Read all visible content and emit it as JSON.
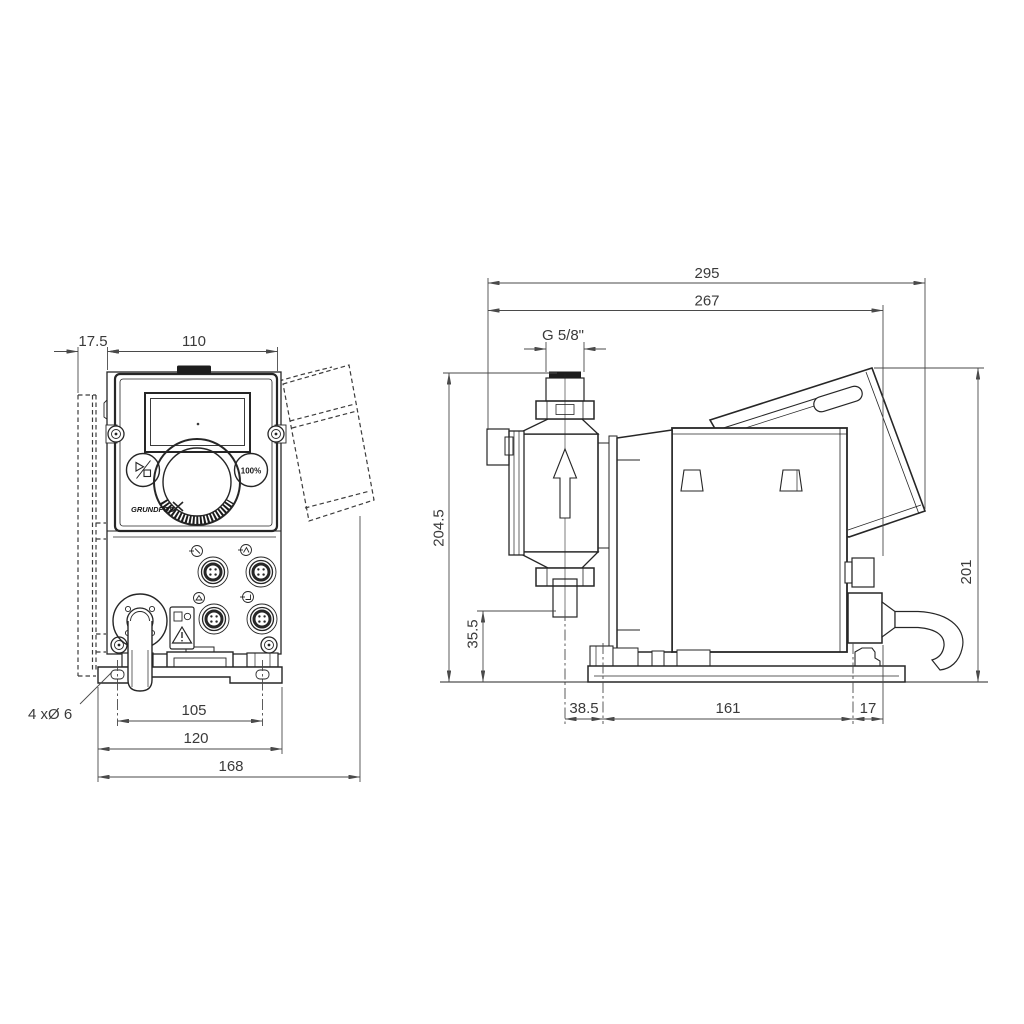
{
  "front_view": {
    "dim_wall_offset": "17.5",
    "dim_panel_width": "110",
    "dim_hole_spacing": "105",
    "dim_plate_width": "120",
    "dim_overall_width": "168",
    "mounting_hole_note": "4 xØ 6",
    "button_100_label": "100%",
    "brand_logo": "GRUNDFOS"
  },
  "side_view": {
    "dim_overall_depth": "295",
    "dim_depth_to_cable_gland": "267",
    "connection_thread": "G 5/8\"",
    "dim_overall_height": "204.5",
    "dim_connection_clearance": "35.5",
    "dim_height_over_base": "201",
    "dim_head_center_to_foot": "38.5",
    "dim_foot_spacing": "161",
    "dim_foot_to_gland": "17"
  }
}
